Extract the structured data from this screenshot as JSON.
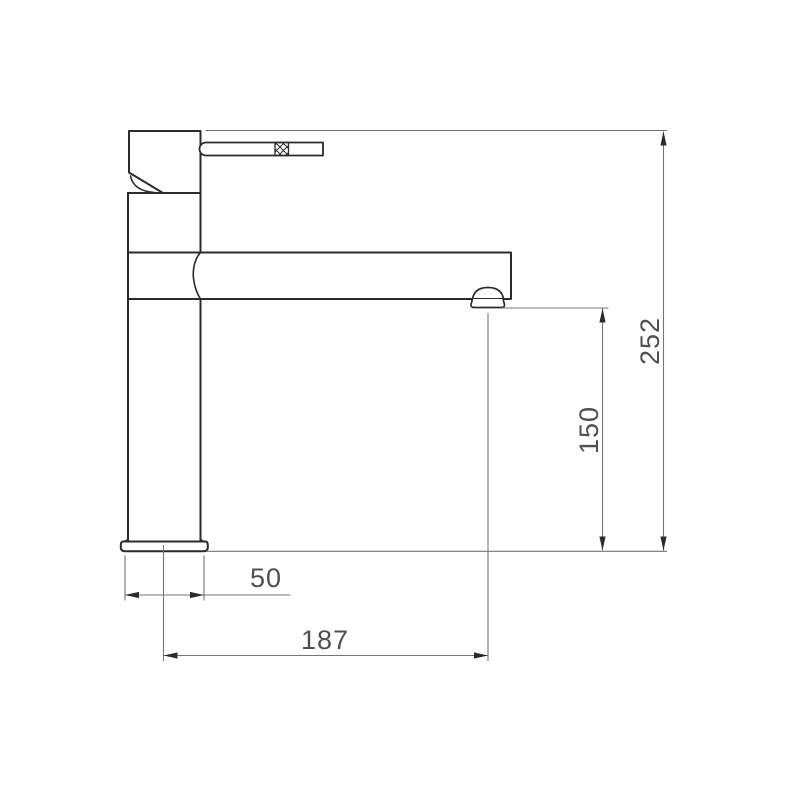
{
  "drawing": {
    "kind": "tap-dimension-drawing"
  },
  "colors": {
    "background": "#ffffff",
    "outline": "#2b2b2b",
    "dimension_lines": "#757575",
    "dimension_text": "#4f4f4f"
  },
  "dimensions": {
    "overall_height": "252",
    "spout_outlet_height": "150",
    "base_width": "50",
    "spout_reach": "187"
  }
}
